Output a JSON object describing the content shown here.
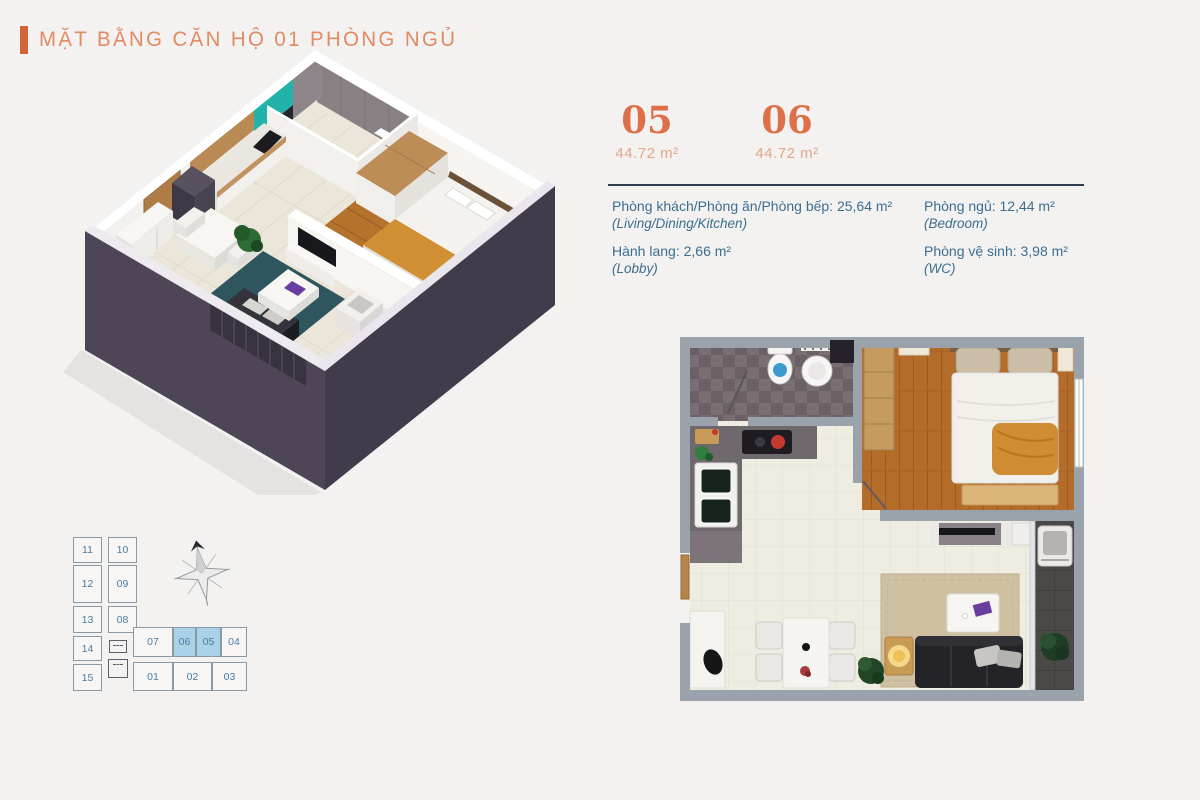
{
  "header": {
    "title": "MẶT BẰNG CĂN HỘ 01 PHÒNG NGỦ"
  },
  "units": [
    {
      "number": "05",
      "area": "44.72 m²"
    },
    {
      "number": "06",
      "area": "44.72 m²"
    }
  ],
  "legend": {
    "items_left": [
      {
        "vi": "Phòng khách/Phòng ăn/Phòng bếp: 25,64 m²",
        "en": "(Living/Dining/Kitchen)"
      },
      {
        "vi": "Hành lang: 2,66 m²",
        "en": "(Lobby)"
      }
    ],
    "items_right": [
      {
        "vi": "Phòng ngủ: 12,44 m²",
        "en": "(Bedroom)"
      },
      {
        "vi": "Phòng vệ sinh: 3,98 m²",
        "en": "(WC)"
      }
    ]
  },
  "keyplan": {
    "units": [
      {
        "label": "11"
      },
      {
        "label": "10"
      },
      {
        "label": "12"
      },
      {
        "label": "09"
      },
      {
        "label": "13"
      },
      {
        "label": "08"
      },
      {
        "label": "14"
      },
      {
        "label": "15"
      },
      {
        "label": "07"
      },
      {
        "label": "06"
      },
      {
        "label": "05"
      },
      {
        "label": "04"
      },
      {
        "label": "01"
      },
      {
        "label": "02"
      },
      {
        "label": "03"
      }
    ],
    "highlighted_units": [
      "06",
      "05"
    ]
  },
  "colors": {
    "accent_bar": "#d2643c",
    "title_text": "#e18a63",
    "unit_number": "#dd6f49",
    "unit_area": "#e3a78c",
    "divider_rule": "#2b3c4e",
    "legend_text": "#3c6e90",
    "keyplan_highlight": "#a9d2e8",
    "keyplan_line": "#8b99a4",
    "keyplan_text": "#4a7da3",
    "wall_dark_3d": "#4e4656",
    "teal_backsplash": "#21b2aa",
    "wood_floor": "#b5722d",
    "plan_wall": "#9aa2ac"
  }
}
